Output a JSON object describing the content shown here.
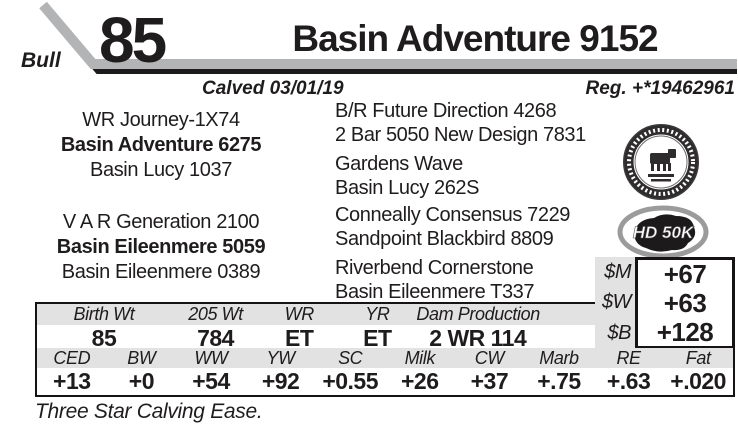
{
  "header": {
    "lot_number": "85",
    "sex_label": "Bull",
    "title": "Basin Adventure 9152",
    "calved_label": "Calved 03/01/19",
    "reg_label": "Reg. +*19462961"
  },
  "pedigree": {
    "sire_line": {
      "grandsire": "WR Journey-1X74",
      "name": "Basin Adventure 6275",
      "granddam": "Basin Lucy 1037",
      "ancestors": [
        "B/R Future Direction 4268",
        "2 Bar 5050 New Design 7831",
        "Gardens Wave",
        "Basin Lucy 262S"
      ]
    },
    "dam_line": {
      "grandsire": "V A R Generation 2100",
      "name": "Basin Eileenmere 5059",
      "granddam": "Basin Eileenmere 0389",
      "ancestors": [
        "Conneally Consensus 7229",
        "Sandpoint Blackbird 8809",
        "Riverbend Cornerstone",
        "Basin Eileenmere T337"
      ]
    }
  },
  "badges": {
    "angus_seal": "american-angus-association-seal",
    "hd50k_label": "HD 50K"
  },
  "dollar_values": {
    "rows": [
      {
        "label": "$M",
        "value": "+67"
      },
      {
        "label": "$W",
        "value": "+63"
      },
      {
        "label": "$B",
        "value": "+128"
      }
    ]
  },
  "performance_table": {
    "headers": [
      "Birth Wt",
      "205 Wt",
      "WR",
      "YR",
      "Dam Production"
    ],
    "values": [
      "85",
      "784",
      "ET",
      "ET",
      "2 WR 114"
    ]
  },
  "epd_table": {
    "headers": [
      "CED",
      "BW",
      "WW",
      "YW",
      "SC",
      "Milk",
      "CW",
      "Marb",
      "RE",
      "Fat"
    ],
    "values": [
      "+13",
      "+0",
      "+54",
      "+92",
      "+0.55",
      "+26",
      "+37",
      "+.75",
      "+.63",
      "+.020"
    ]
  },
  "footnote": "Three Star Calving Ease.",
  "colors": {
    "bar_gray": "#b2b4b6",
    "table_header_gray": "#e2e2e3",
    "ink": "#1f1c1d"
  }
}
